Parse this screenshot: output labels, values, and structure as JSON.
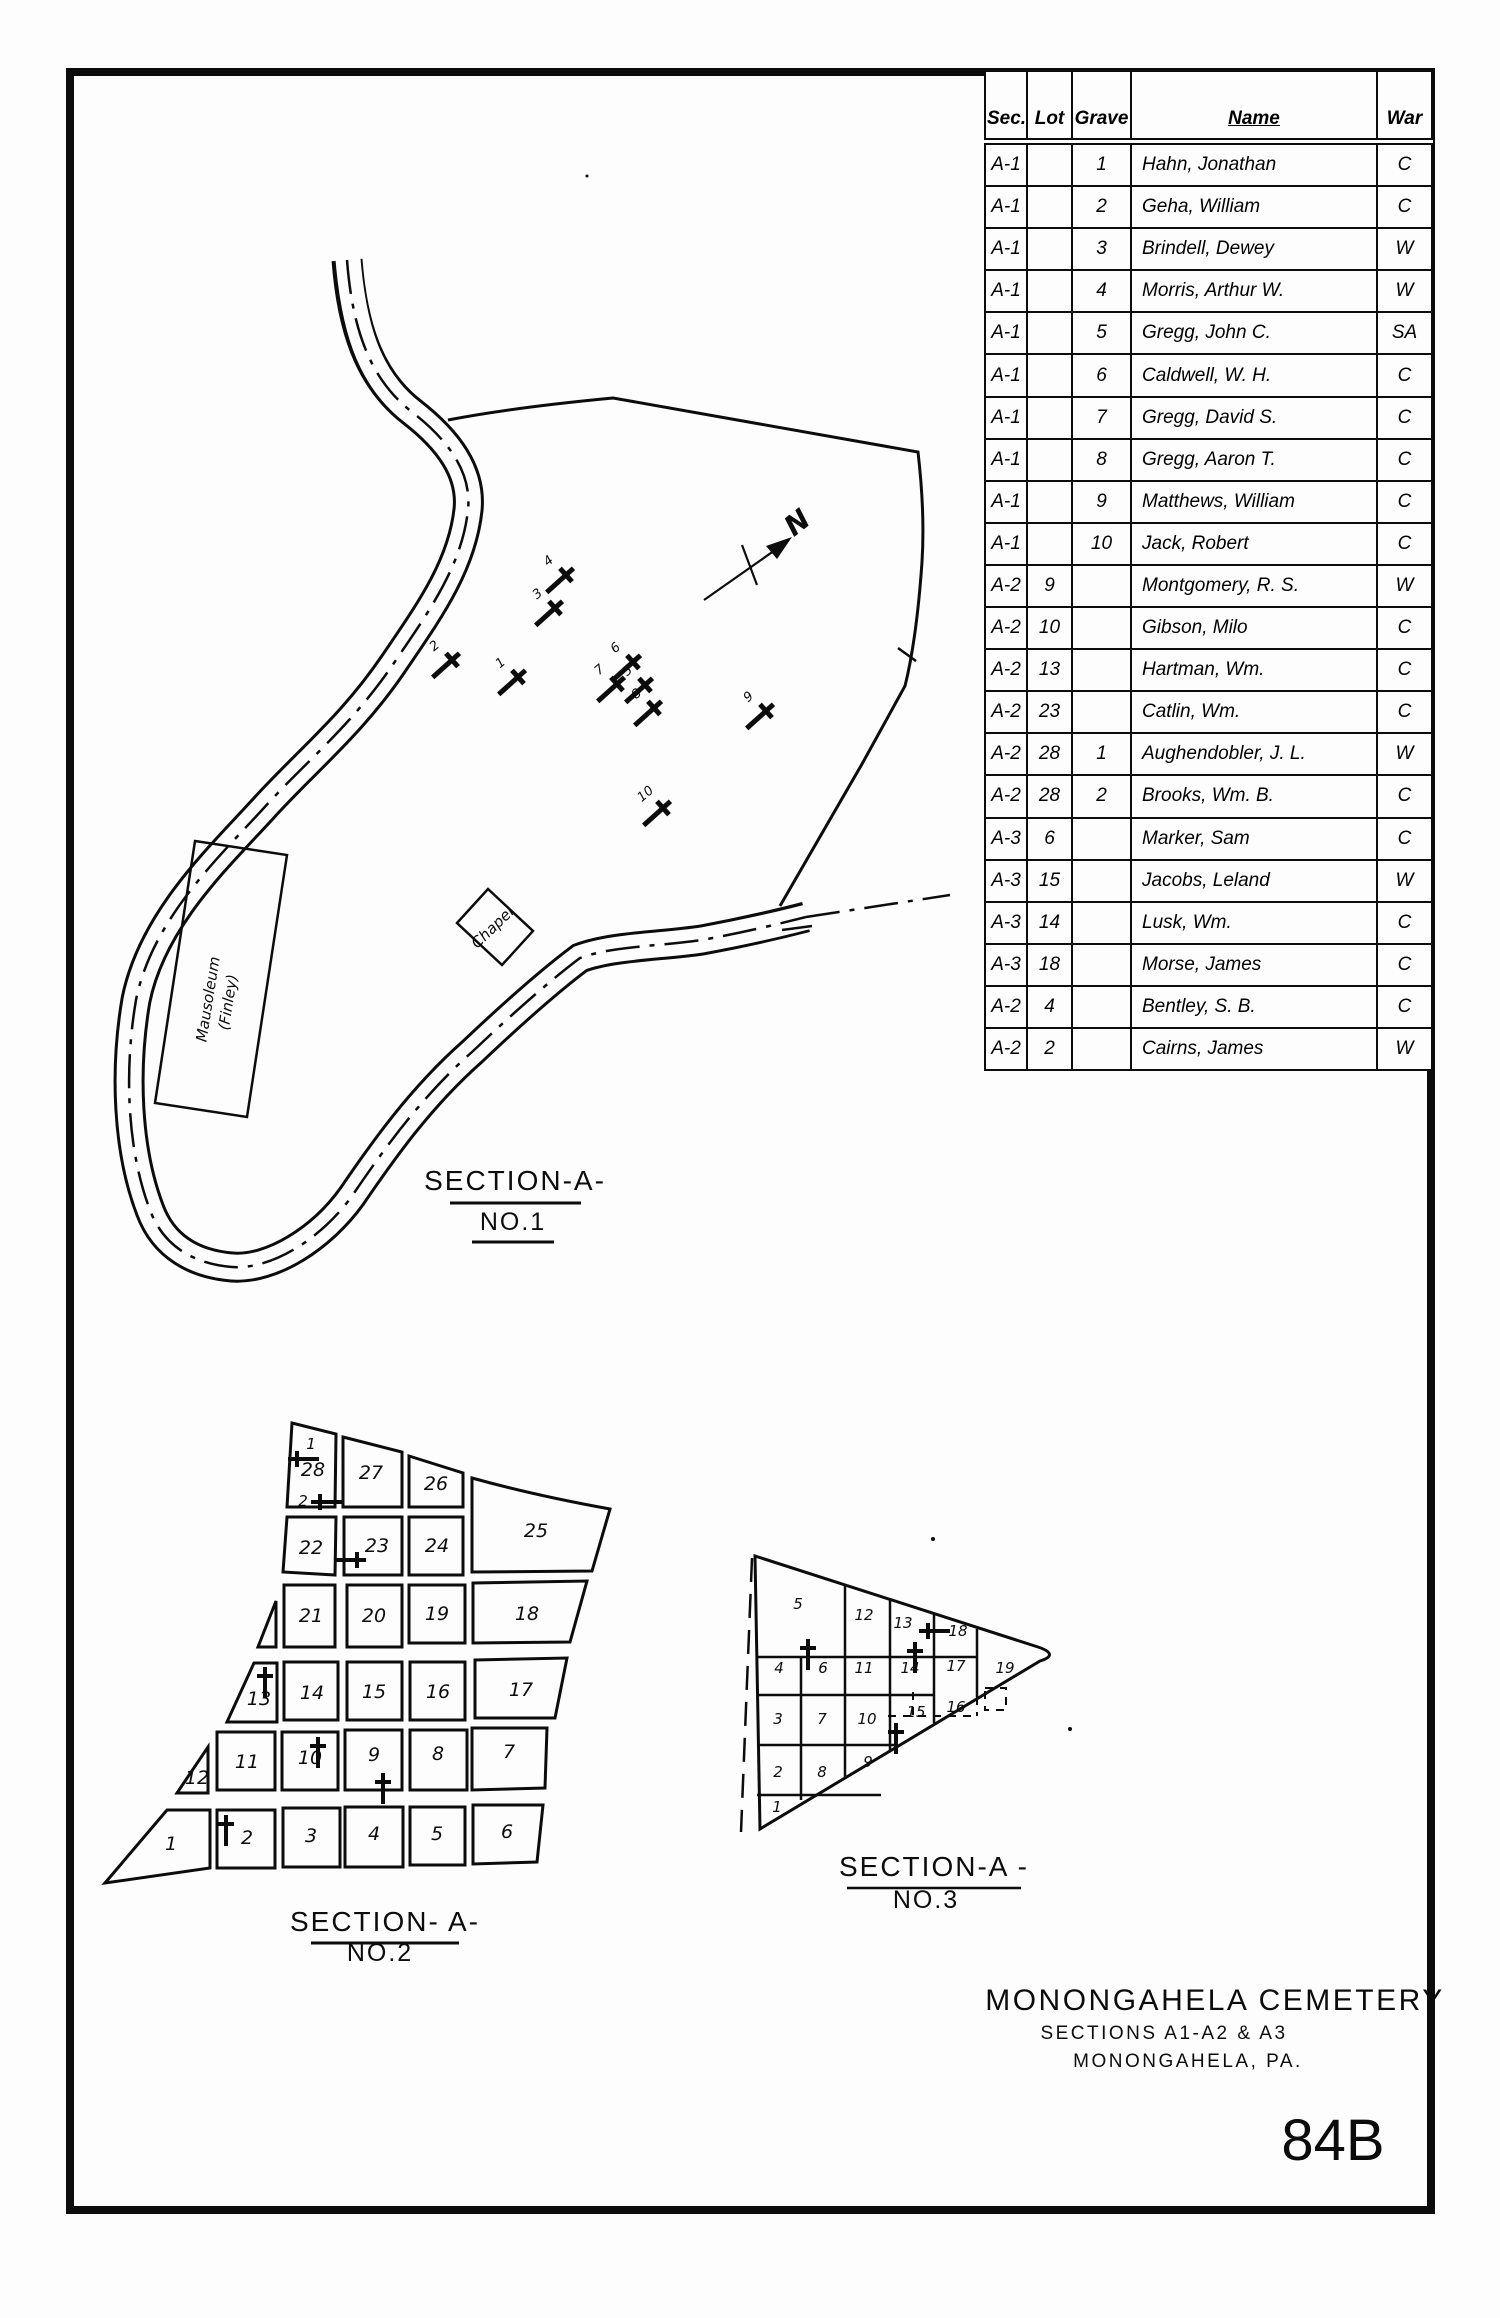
{
  "table": {
    "headers": [
      "Sec.",
      "Lot",
      "Grave",
      "Name",
      "War"
    ],
    "rows": [
      [
        "A-1",
        "",
        "1",
        "Hahn, Jonathan",
        "C"
      ],
      [
        "A-1",
        "",
        "2",
        "Geha, William",
        "C"
      ],
      [
        "A-1",
        "",
        "3",
        "Brindell, Dewey",
        "W"
      ],
      [
        "A-1",
        "",
        "4",
        "Morris, Arthur W.",
        "W"
      ],
      [
        "A-1",
        "",
        "5",
        "Gregg, John C.",
        "SA"
      ],
      [
        "A-1",
        "",
        "6",
        "Caldwell, W. H.",
        "C"
      ],
      [
        "A-1",
        "",
        "7",
        "Gregg, David S.",
        "C"
      ],
      [
        "A-1",
        "",
        "8",
        "Gregg, Aaron T.",
        "C"
      ],
      [
        "A-1",
        "",
        "9",
        "Matthews, William",
        "C"
      ],
      [
        "A-1",
        "",
        "10",
        "Jack, Robert",
        "C"
      ],
      [
        "A-2",
        "9",
        "",
        "Montgomery, R. S.",
        "W"
      ],
      [
        "A-2",
        "10",
        "",
        "Gibson, Milo",
        "C"
      ],
      [
        "A-2",
        "13",
        "",
        "Hartman, Wm.",
        "C"
      ],
      [
        "A-2",
        "23",
        "",
        "Catlin, Wm.",
        "C"
      ],
      [
        "A-2",
        "28",
        "1",
        "Aughendobler, J. L.",
        "W"
      ],
      [
        "A-2",
        "28",
        "2",
        "Brooks, Wm. B.",
        "C"
      ],
      [
        "A-3",
        "6",
        "",
        "Marker, Sam",
        "C"
      ],
      [
        "A-3",
        "15",
        "",
        "Jacobs, Leland",
        "W"
      ],
      [
        "A-3",
        "14",
        "",
        "Lusk, Wm.",
        "C"
      ],
      [
        "A-3",
        "18",
        "",
        "Morse, James",
        "C"
      ],
      [
        "A-2",
        "4",
        "",
        "Bentley, S. B.",
        "C"
      ],
      [
        "A-2",
        "2",
        "",
        "Cairns, James",
        "W"
      ]
    ]
  },
  "map": {
    "north_label": "N",
    "section1": {
      "title": "SECTION-A-",
      "subtitle": "NO.1",
      "chapel_label": "Chapel",
      "mausoleum_label1": "Mausoleum",
      "mausoleum_label2": "(Finley)",
      "graves": [
        {
          "n": "1",
          "x": 518,
          "y": 677
        },
        {
          "n": "2",
          "x": 452,
          "y": 660
        },
        {
          "n": "3",
          "x": 555,
          "y": 608
        },
        {
          "n": "4",
          "x": 566,
          "y": 575
        },
        {
          "n": "5",
          "x": 645,
          "y": 685
        },
        {
          "n": "6",
          "x": 633,
          "y": 662
        },
        {
          "n": "7",
          "x": 617,
          "y": 684
        },
        {
          "n": "8",
          "x": 654,
          "y": 708
        },
        {
          "n": "9",
          "x": 766,
          "y": 711
        },
        {
          "n": "10",
          "x": 663,
          "y": 808
        }
      ]
    },
    "section2": {
      "title": "SECTION- A-",
      "subtitle": "NO.2",
      "lots": [
        {
          "n": "28",
          "x": 313,
          "y": 1476
        },
        {
          "n": "27",
          "x": 371,
          "y": 1479
        },
        {
          "n": "26",
          "x": 436,
          "y": 1490
        },
        {
          "n": "25",
          "x": 536,
          "y": 1537
        },
        {
          "n": "22",
          "x": 311,
          "y": 1554
        },
        {
          "n": "23",
          "x": 377,
          "y": 1552
        },
        {
          "n": "24",
          "x": 437,
          "y": 1552
        },
        {
          "n": "21",
          "x": 311,
          "y": 1622
        },
        {
          "n": "20",
          "x": 374,
          "y": 1622
        },
        {
          "n": "19",
          "x": 437,
          "y": 1620
        },
        {
          "n": "18",
          "x": 527,
          "y": 1620
        },
        {
          "n": "13",
          "x": 259,
          "y": 1705
        },
        {
          "n": "14",
          "x": 312,
          "y": 1699
        },
        {
          "n": "15",
          "x": 374,
          "y": 1698
        },
        {
          "n": "16",
          "x": 438,
          "y": 1698
        },
        {
          "n": "17",
          "x": 521,
          "y": 1696
        },
        {
          "n": "12",
          "x": 197,
          "y": 1784
        },
        {
          "n": "11",
          "x": 247,
          "y": 1768
        },
        {
          "n": "10",
          "x": 310,
          "y": 1764
        },
        {
          "n": "9",
          "x": 374,
          "y": 1761
        },
        {
          "n": "8",
          "x": 438,
          "y": 1760
        },
        {
          "n": "7",
          "x": 509,
          "y": 1758
        },
        {
          "n": "1",
          "x": 171,
          "y": 1850
        },
        {
          "n": "2",
          "x": 247,
          "y": 1844
        },
        {
          "n": "3",
          "x": 311,
          "y": 1842
        },
        {
          "n": "4",
          "x": 374,
          "y": 1840
        },
        {
          "n": "5",
          "x": 437,
          "y": 1840
        },
        {
          "n": "6",
          "x": 507,
          "y": 1838
        }
      ],
      "crosses": [
        {
          "x": 297,
          "y": 1459,
          "rot": -90,
          "label": "1",
          "lx": 14,
          "ly": -10
        },
        {
          "x": 320,
          "y": 1502,
          "rot": -90,
          "label": "2",
          "lx": -17,
          "ly": 4
        },
        {
          "x": 357,
          "y": 1560,
          "rot": 90
        },
        {
          "x": 265,
          "y": 1676,
          "rot": 0
        },
        {
          "x": 318,
          "y": 1746,
          "rot": 0
        },
        {
          "x": 383,
          "y": 1782,
          "rot": 0
        },
        {
          "x": 226,
          "y": 1824,
          "rot": 0
        }
      ]
    },
    "section3": {
      "title": "SECTION-A -",
      "subtitle": "NO.3",
      "lots": [
        {
          "n": "5",
          "x": 798,
          "y": 1609
        },
        {
          "n": "12",
          "x": 864,
          "y": 1620
        },
        {
          "n": "13",
          "x": 903,
          "y": 1628
        },
        {
          "n": "18",
          "x": 958,
          "y": 1636
        },
        {
          "n": "4",
          "x": 779,
          "y": 1673
        },
        {
          "n": "6",
          "x": 823,
          "y": 1673
        },
        {
          "n": "11",
          "x": 864,
          "y": 1673
        },
        {
          "n": "14",
          "x": 910,
          "y": 1673
        },
        {
          "n": "17",
          "x": 956,
          "y": 1671
        },
        {
          "n": "19",
          "x": 1005,
          "y": 1673
        },
        {
          "n": "3",
          "x": 778,
          "y": 1724
        },
        {
          "n": "7",
          "x": 822,
          "y": 1724
        },
        {
          "n": "10",
          "x": 867,
          "y": 1724
        },
        {
          "n": "15",
          "x": 916,
          "y": 1717
        },
        {
          "n": "16",
          "x": 956,
          "y": 1712
        },
        {
          "n": "2",
          "x": 778,
          "y": 1777
        },
        {
          "n": "8",
          "x": 822,
          "y": 1777
        },
        {
          "n": "9",
          "x": 868,
          "y": 1767
        },
        {
          "n": "1",
          "x": 777,
          "y": 1812
        }
      ],
      "crosses": [
        {
          "x": 928,
          "y": 1631,
          "rot": -90
        },
        {
          "x": 808,
          "y": 1648,
          "rot": 0
        },
        {
          "x": 915,
          "y": 1651,
          "rot": 0
        },
        {
          "x": 896,
          "y": 1732,
          "rot": 0
        }
      ]
    }
  },
  "title_block": {
    "line1": "MONONGAHELA CEMETERY",
    "line2": "SECTIONS A1-A2 & A3",
    "line3": "MONONGAHELA, PA.",
    "sheet_number": "84B"
  }
}
